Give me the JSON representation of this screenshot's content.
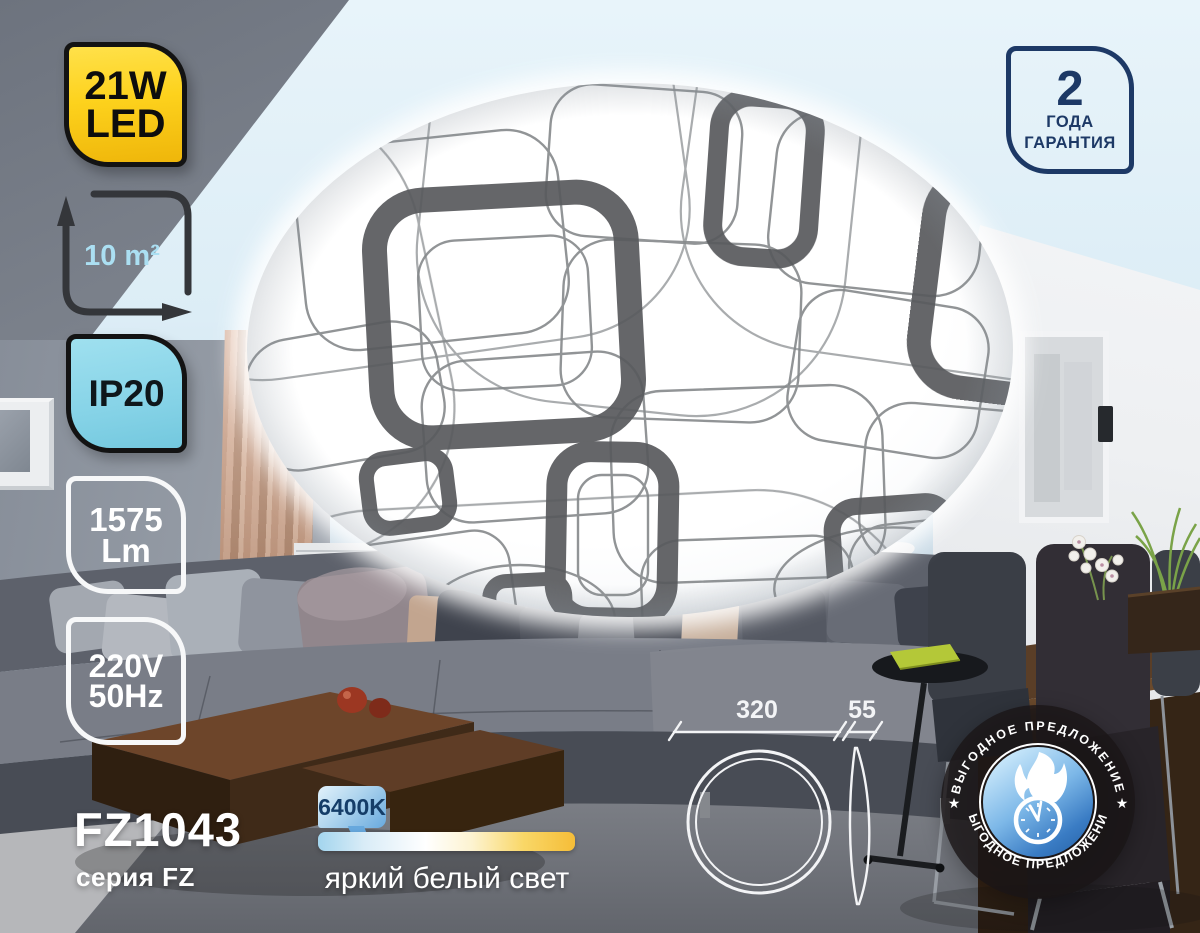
{
  "badges": {
    "power_line1": "21W",
    "power_line2": "LED",
    "area": "10 m²",
    "ip_rating": "IP20",
    "lumens_value": "1575",
    "lumens_unit": "Lm",
    "voltage": "220V",
    "frequency": "50Hz"
  },
  "warranty": {
    "years": "2",
    "word1": "ГОДА",
    "word2": "ГАРАНТИЯ"
  },
  "product": {
    "model": "FZ1043",
    "series": "серия FZ"
  },
  "color_temperature": {
    "value": "6400K",
    "description": "яркий белый свет"
  },
  "dimensions": {
    "diameter_mm": "320",
    "height_mm": "55"
  },
  "promo_seal": {
    "text_top": "ВЫГОДНОЕ ПРЕДЛОЖЕНИЕ",
    "text_bottom": "ВЫГОДНОЕ ПРЕДЛОЖЕНИЕ",
    "star_left": "★",
    "star_right": "★"
  },
  "colors": {
    "power_badge_yellow": "#fdd21d",
    "ip_badge_cyan": "#86d3e7",
    "warranty_navy": "#1d3966",
    "cool_end_blue": "#a3d5ee",
    "warm_end_amber": "#f5bd38",
    "seal_blue": "#3a7cc4",
    "lamp_pattern_gray": "#5a5b5e"
  }
}
